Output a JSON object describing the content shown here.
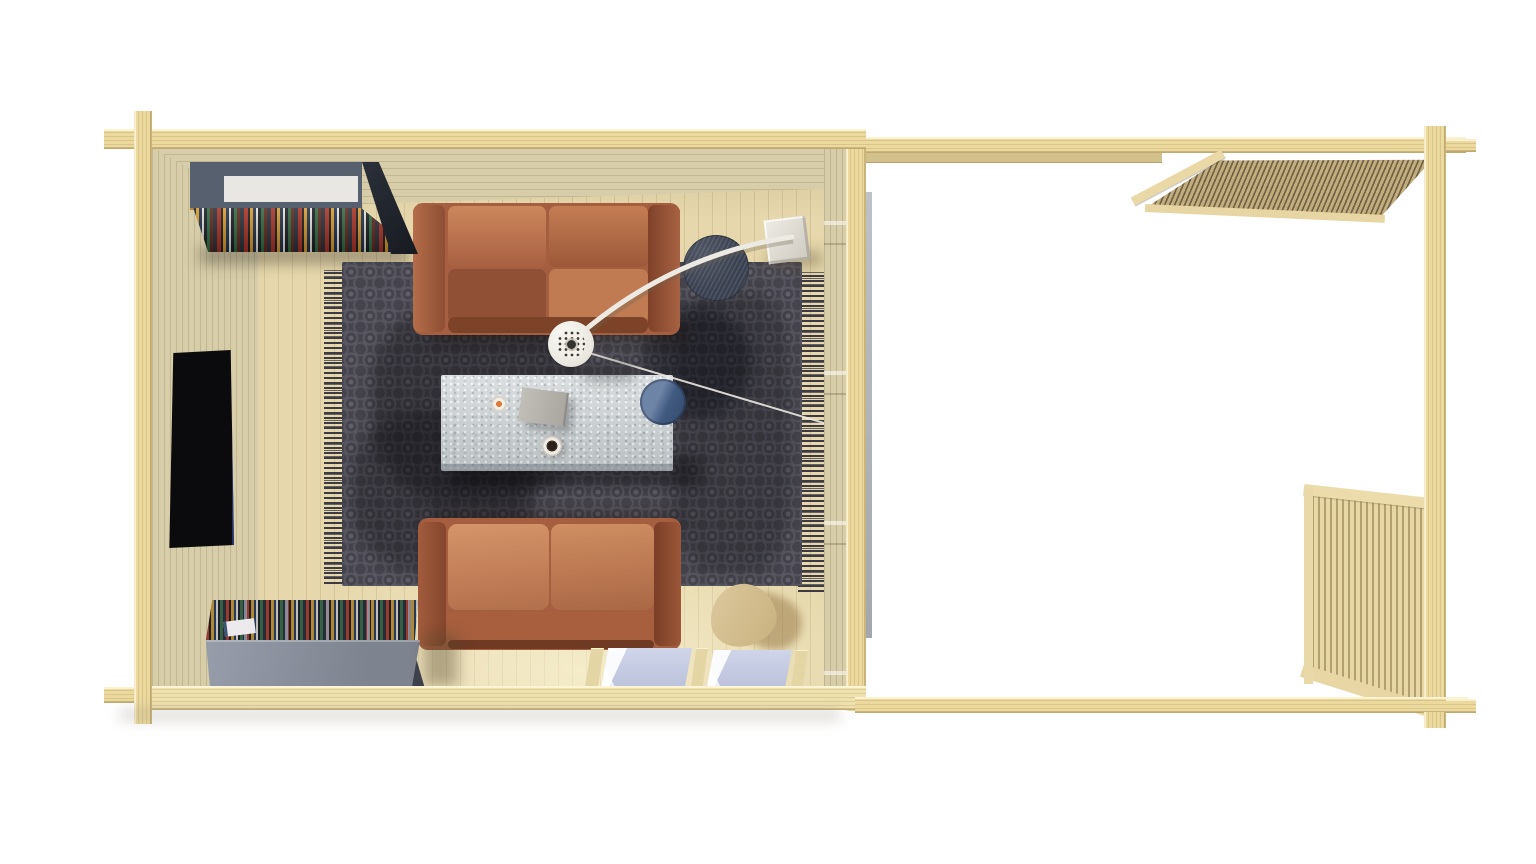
{
  "page": {
    "background": "#ffffff",
    "view": "top-down 3d architectural render",
    "subject": "log cabin with furnished living room and open pergola terrace"
  },
  "palette": {
    "background": "#ffffff",
    "beam": "#ecd99d",
    "beam_lit": "#f0e2ae",
    "wall_face": "#d7cda9",
    "floor": "#e6d8ac",
    "rug": "#45444c",
    "rug_fringe": "#3c3b44",
    "sofa_leather": "#b5694a",
    "sofa_shadow": "#8d4e33",
    "table_stone": "#cfd4d6",
    "bowl_blue": "#51688c",
    "side_table": "#3a4150",
    "lamp_white": "#f3f1ea",
    "shelf_gray": "#57606e",
    "shelf_panel": "#e8e7e3",
    "shelf_front": "#989eab",
    "books_dark": "#15171c",
    "chair_wood": "#dcc99e",
    "glass_blue": "#d0d5ea",
    "tv_black": "#0b0b0d",
    "slat_dark": "#6e5f45",
    "slat_light": "#c2ad7d"
  },
  "scene": {
    "living_room": {
      "walls": "pale timber plank walls seen from above",
      "floor": "light wooden plank floor",
      "items": [
        {
          "name": "wall-tv",
          "color": "#0b0b0d"
        },
        {
          "name": "bookshelf-north",
          "colors": [
            "#57606e",
            "#e8e7e3"
          ],
          "detail": "wall unit with colorful books"
        },
        {
          "name": "bookshelf-south",
          "colors": [
            "#989eab",
            "#262a32"
          ],
          "detail": "low gray shelf with books"
        },
        {
          "name": "area-rug",
          "color": "#45444c",
          "detail": "dark patterned rug with fringed ends"
        },
        {
          "name": "sofa-north",
          "color": "#b5694a",
          "detail": "two-seat terracotta leather sofa"
        },
        {
          "name": "sofa-south",
          "color": "#c07a52",
          "detail": "two-seat terracotta leather sofa"
        },
        {
          "name": "coffee-table",
          "color": "#cfd4d6",
          "items": [
            "blue-bowl",
            "gray-book",
            "coffee-cup",
            "small-dish"
          ]
        },
        {
          "name": "round-side-table",
          "color": "#3a4150"
        },
        {
          "name": "arc-floor-lamp",
          "colors": [
            "#f3f1ea",
            "#d9d6cc"
          ],
          "detail": "white arc lamp with perforated shade and cube base"
        },
        {
          "name": "wooden-chair",
          "color": "#dcc99e"
        },
        {
          "name": "glazed-floor-windows",
          "color": "#d0d5ea"
        }
      ]
    },
    "terrace": {
      "floor": "blown-out white, unrendered",
      "items": [
        {
          "name": "pergola-slat-roof",
          "color": "#c2ad7d"
        },
        {
          "name": "corner-post",
          "color": "#ecd99d"
        },
        {
          "name": "slatted-railing",
          "color": "#e7d7a5"
        },
        {
          "name": "frame-beams",
          "color": "#ecd99d"
        }
      ]
    }
  }
}
